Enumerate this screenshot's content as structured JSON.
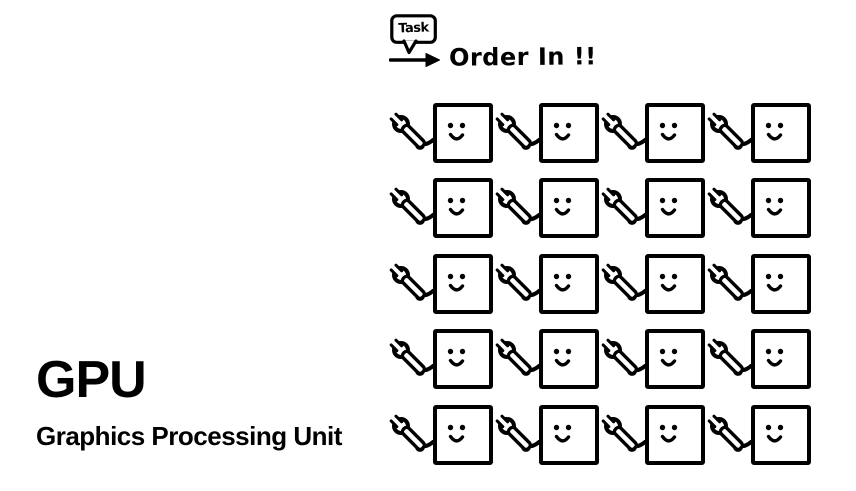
{
  "canvas": {
    "width": 856,
    "height": 491,
    "background_color": "#ffffff",
    "ink_color": "#000000"
  },
  "title_block": {
    "title": "GPU",
    "subtitle": "Graphics Processing Unit"
  },
  "annotation": {
    "bubble_label": "Task",
    "bubble_icon": "task-speech-bubble",
    "arrow_icon": "right-arrow-icon",
    "caption": "Order In !!"
  },
  "grid": {
    "rows": 5,
    "columns": 4,
    "cell_count": 20,
    "wrench_icon": "wrench-icon",
    "core_icon": "smiley-core-icon"
  }
}
